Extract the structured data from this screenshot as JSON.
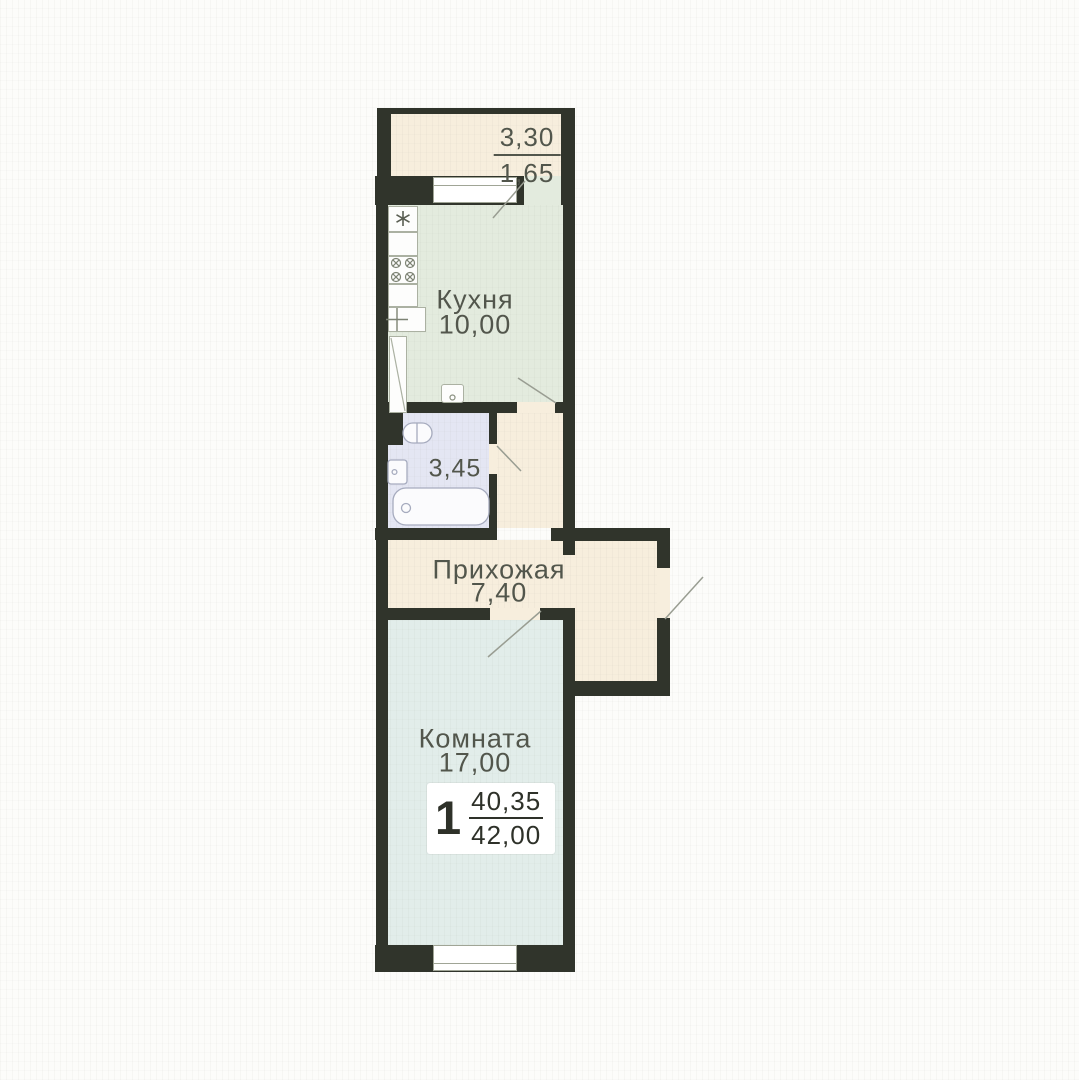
{
  "colors": {
    "bg": "#fcfcfa",
    "wall": "#30342b",
    "hallway": "#f7eedd",
    "balcony": "#f7eedd",
    "kitchen": "#e3ebde",
    "bathroom": "#e4e6f3",
    "room": "#e2edea",
    "label": "#52564c",
    "badge-text": "#2e3129",
    "door-line": "#999d92",
    "window-border": "#a0a596",
    "kitchen-fixture": "#abb1a2",
    "bath-fixture": "#a6abbe"
  },
  "rooms": {
    "balcony": {
      "dim_numerator": "3,30",
      "dim_denominator": "1,65"
    },
    "kitchen": {
      "name": "Кухня",
      "area": "10,00"
    },
    "bathroom": {
      "area": "3,45"
    },
    "hallway": {
      "name": "Прихожая",
      "area": "7,40"
    },
    "room": {
      "name": "Комната",
      "area": "17,00"
    }
  },
  "summary": {
    "room_count": "1",
    "living_area": "40,35",
    "total_area": "42,00"
  }
}
